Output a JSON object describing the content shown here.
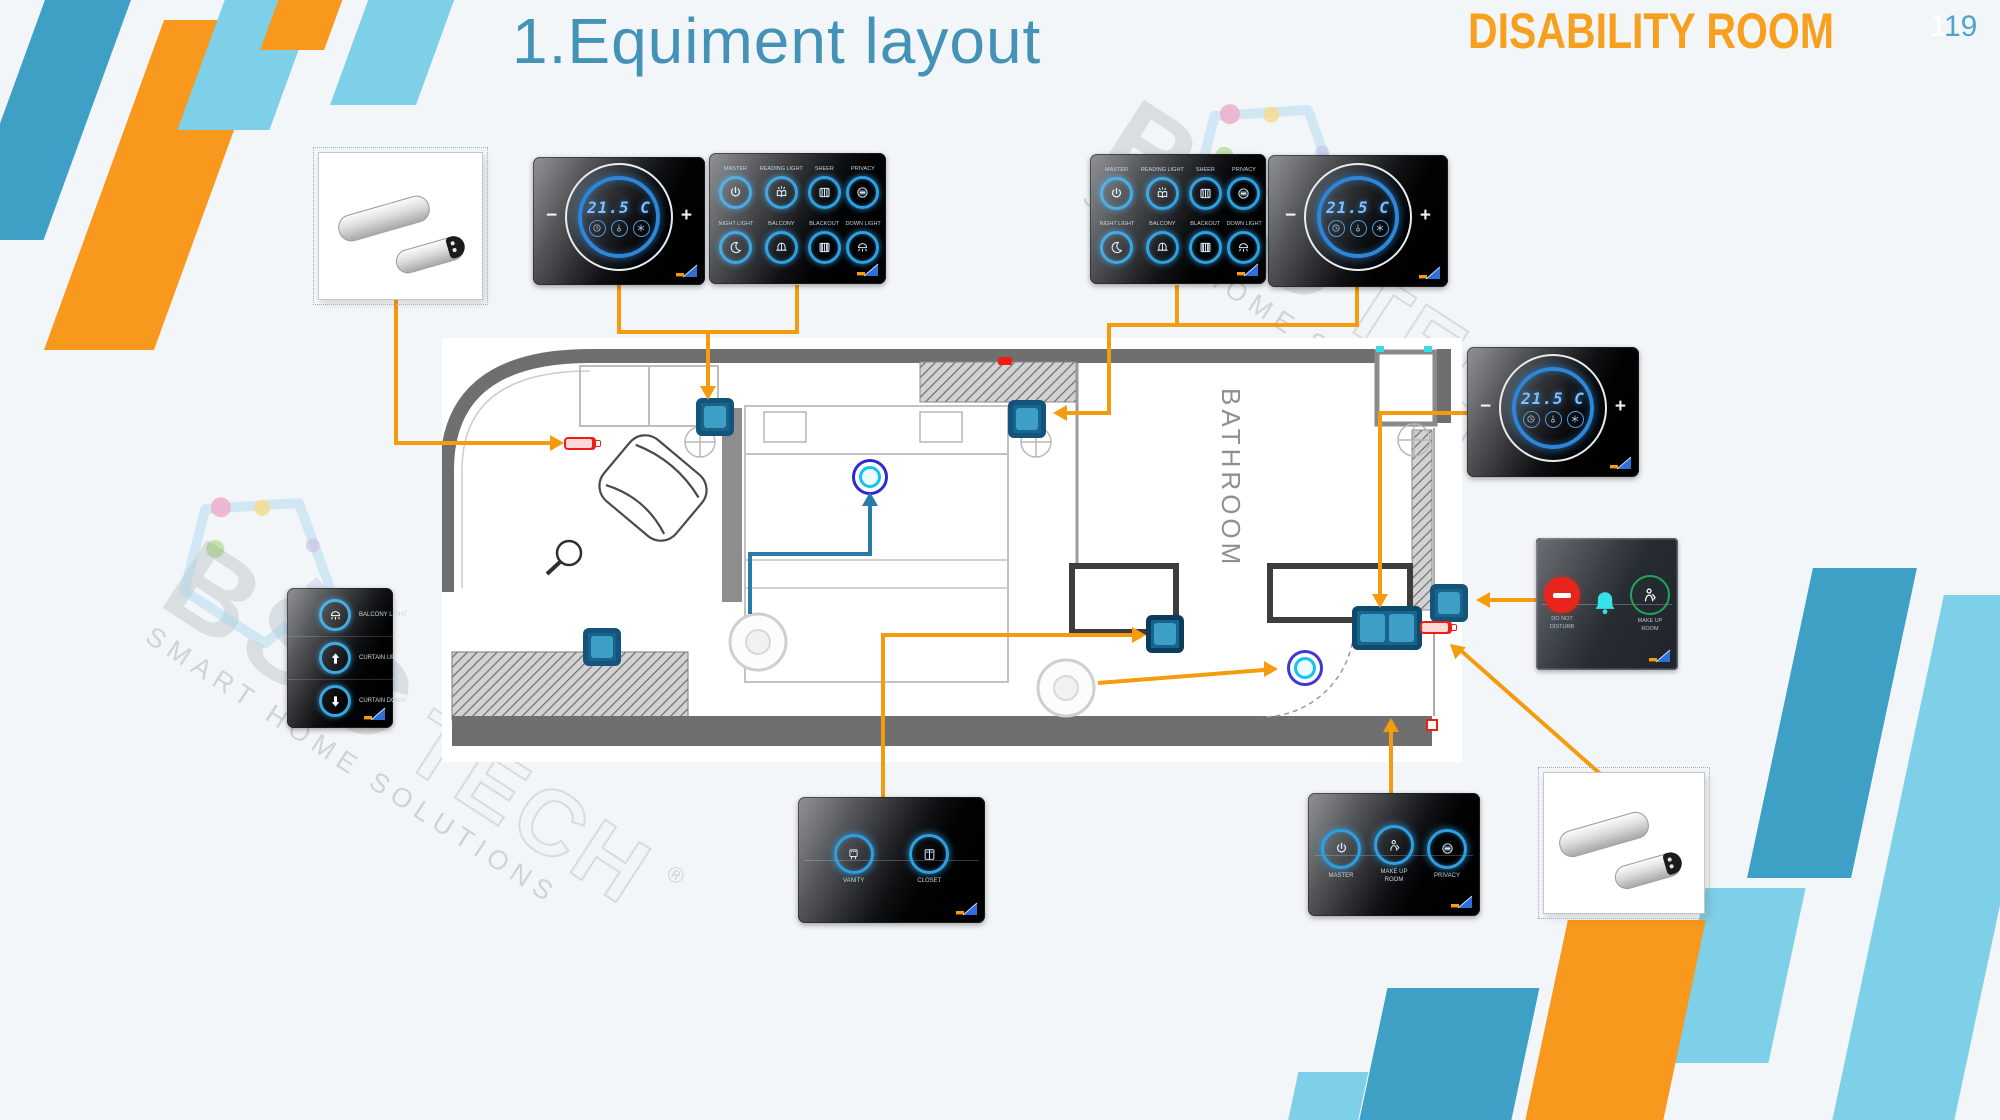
{
  "header": {
    "title": "1.Equiment layout",
    "room_type": "DISABILITY ROOM",
    "page_number": "19",
    "page_number_ghost": "1"
  },
  "watermark": {
    "brand": "BSC",
    "brand_suffix": "TECH",
    "registered_mark": "®",
    "tagline": "SMART HOME SOLUTIONS"
  },
  "floorplan": {
    "bathroom_label": "BATHROOM"
  },
  "panels": {
    "thermostat": {
      "temperature": "21.5 C",
      "decrease_label": "−",
      "increase_label": "+",
      "icons": [
        "timer-icon",
        "thermometer-icon",
        "fan-icon"
      ]
    },
    "scene_switch_8": {
      "buttons": [
        {
          "label": "MASTER",
          "icon": "power-icon"
        },
        {
          "label": "READING LIGHT",
          "icon": "reading-light-icon"
        },
        {
          "label": "SHEER",
          "icon": "sheer-curtain-icon"
        },
        {
          "label": "PRIVACY",
          "icon": "privacy-icon"
        },
        {
          "label": "NIGHT LIGHT",
          "icon": "moon-icon"
        },
        {
          "label": "BALCONY",
          "icon": "balcony-light-icon"
        },
        {
          "label": "BLACKOUT",
          "icon": "blackout-curtain-icon"
        },
        {
          "label": "DOWN LIGHT",
          "icon": "down-light-icon"
        }
      ]
    },
    "curtain_switch_3": {
      "buttons": [
        {
          "label": "BALCONY LIGHT",
          "icon": "dome-light-icon"
        },
        {
          "label": "CURTAIN UP",
          "icon": "arrow-up-icon"
        },
        {
          "label": "CURTAIN DOWN",
          "icon": "arrow-down-icon"
        }
      ]
    },
    "bathroom_switch_2": {
      "buttons": [
        {
          "label": "VANITY",
          "icon": "vanity-light-icon"
        },
        {
          "label": "CLOSET",
          "icon": "closet-icon"
        }
      ]
    },
    "service_switch_3": {
      "buttons": [
        {
          "label": "MASTER",
          "icon": "power-icon"
        },
        {
          "label": "MAKE UP\nROOM",
          "icon": "housekeeping-icon"
        },
        {
          "label": "PRIVACY",
          "icon": "privacy-icon"
        }
      ]
    },
    "doorbell_panel": {
      "items": [
        {
          "label": "DO NOT\nDISTURB",
          "icon": "dnd-icon"
        },
        {
          "label": "",
          "icon": "bell-icon"
        },
        {
          "label": "MAKE UP\nROOM",
          "icon": "housekeeping-icon"
        }
      ]
    }
  },
  "colors": {
    "accent_orange": "#f8991d",
    "accent_blue": "#3fa0c6",
    "accent_light_blue": "#7ecfe8",
    "connector_orange": "#f59b0e",
    "connector_teal": "#2a7ca6",
    "switch_blue": "#3e9fc6",
    "title_blue": "#4493b6",
    "room_label_orange": "#f7a01e"
  }
}
